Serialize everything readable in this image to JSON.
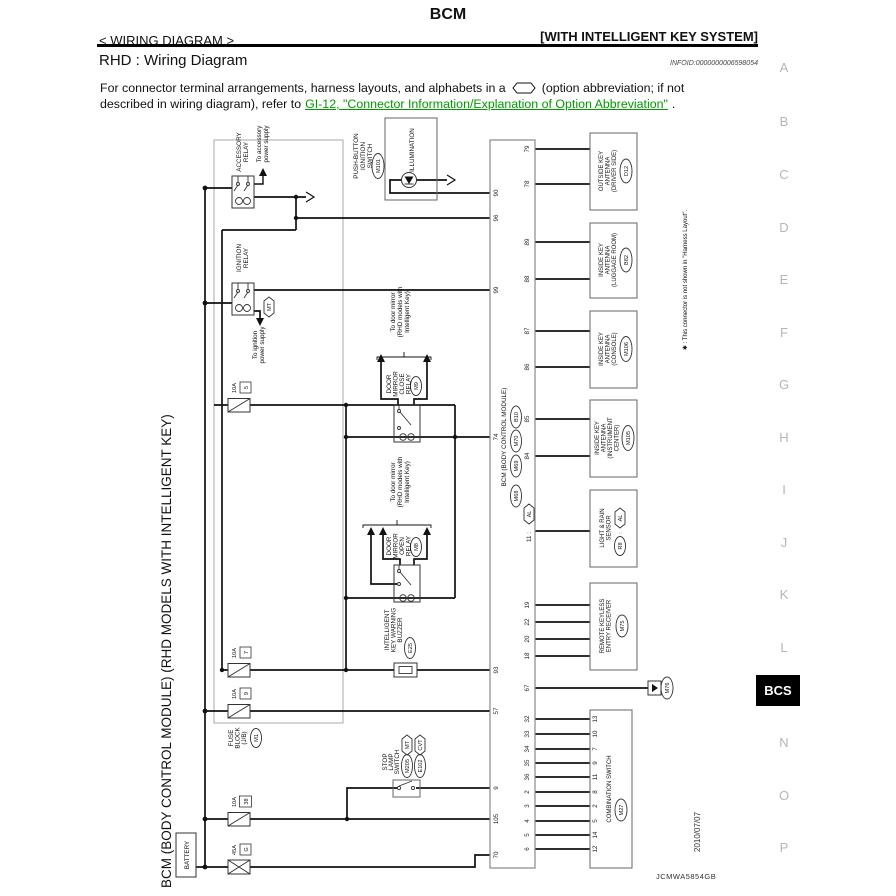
{
  "header": {
    "title": "BCM",
    "breadcrumb": "< WIRING DIAGRAM >",
    "system_tag": "[WITH INTELLIGENT KEY SYSTEM]",
    "section_title": "RHD : Wiring Diagram",
    "infoid": "INFOID:0000000006598054",
    "body_line1_pre": "For connector terminal arrangements, harness layouts, and alphabets in a",
    "body_line1_post": "(option abbreviation; if not",
    "body_line2_pre": "described in wiring diagram), refer to",
    "body_link": "GI-12, \"Connector Information/Explanation of Option Abbreviation\"",
    "body_line2_post": ".",
    "link_color": "#009900"
  },
  "sidebar": {
    "letters": [
      "A",
      "B",
      "C",
      "D",
      "E",
      "F",
      "G",
      "H",
      "I",
      "J",
      "K",
      "L"
    ],
    "tab": "BCS",
    "letters2": [
      "N",
      "O",
      "P"
    ]
  },
  "d": {
    "side_label": "BCM (BODY CONTROL MODULE) (RHD MODELS WITH INTELLIGENT KEY)",
    "battery": "BATTERY",
    "acc": [
      "ACCESSORY",
      "RELAY"
    ],
    "acc_note": [
      "To accessory",
      "power supply"
    ],
    "ign": [
      "IGNITION",
      "RELAY"
    ],
    "ign_note": [
      "To ignition",
      "power supply"
    ],
    "ign_tag": "MT",
    "pbs": [
      "PUSH-BUTTON",
      "IGNITION",
      "SWITCH"
    ],
    "pbs_conn": "M101",
    "illum": "ILLUMINATION",
    "mirror_note": [
      "To door mirror",
      "(RHD models with",
      "Intelligent Key)"
    ],
    "close_relay": [
      "DOOR",
      "MIRROR",
      "CLOSE",
      "RELAY"
    ],
    "close_conn": "M9",
    "open_relay": [
      "DOOR",
      "MIRROR",
      "OPEN",
      "RELAY"
    ],
    "open_conn": "M8",
    "buzzer": [
      "INTELLIGENT",
      "KEY WARNING",
      "BUZZER"
    ],
    "buzzer_conn": "E25",
    "fuse_block": [
      "FUSE",
      "BLOCK",
      "(J/B)"
    ],
    "fuse_block_conn": "M1",
    "stop": [
      "STOP",
      "LAMP",
      "SWITCH"
    ],
    "stop_tag1": "MT",
    "stop_conn1": "M205",
    "stop_tag2": "CVT",
    "stop_conn2": "E102",
    "fuses": {
      "f5a": "10A",
      "f5n": "5",
      "f7a": "10A",
      "f7n": "7",
      "f9a": "10A",
      "f9n": "9",
      "f38a": "10A",
      "f38n": "38",
      "fla": "45A",
      "fln": "G"
    },
    "bcm_label": "BCM (BODY CONTROL MODULE)",
    "bcm_conns": [
      "M68",
      "M69",
      "M70",
      "B10"
    ],
    "pl": [
      "90",
      "96",
      "99",
      "74",
      "93",
      "57",
      "9",
      "105",
      "70"
    ],
    "pr": [
      "79",
      "78",
      "89",
      "88",
      "87",
      "86",
      "85",
      "84",
      "19",
      "22",
      "20",
      "18",
      "67"
    ],
    "pin11": "11 :",
    "pin11_tag": "AL",
    "cb": [
      "32",
      "33",
      "34",
      "35",
      "36",
      "2",
      "3",
      "4",
      "5",
      "6"
    ],
    "cs": [
      "13",
      "10",
      "7",
      "9",
      "11",
      "8",
      "2",
      "5",
      "14",
      "12"
    ],
    "ant1": [
      "OUTSIDE KEY",
      "ANTENNA",
      "(DRIVER SIDE)"
    ],
    "ant1_conn": "D12",
    "ant2": [
      "INSIDE KEY",
      "ANTENNA",
      "(LUGGAGE ROOM)"
    ],
    "ant2_conn": "B82",
    "ant3": [
      "INSIDE KEY",
      "ANTENNA",
      "(CONSOLE)"
    ],
    "ant3_conn": "M106",
    "ant4": [
      "INSIDE KEY",
      "ANTENNA",
      "(INSTRUMENT",
      "CENTER)"
    ],
    "ant4_conn": "M105",
    "rain": [
      "LIGHT & RAIN",
      "SENSOR"
    ],
    "rain_conn": "R8",
    "rain_tag": "AL",
    "rke": [
      "REMOTE KEYLESS",
      "ENTRY RECEIVER"
    ],
    "rke_conn": "M75",
    "combo": "COMBINATION SWITCH",
    "combo_conn": "M27",
    "m76": "M76",
    "footnote": "✱ : This connector is not shown in \"Harness Layout\".",
    "code": "JCMWA5854GB",
    "date": "2010/07/07"
  }
}
